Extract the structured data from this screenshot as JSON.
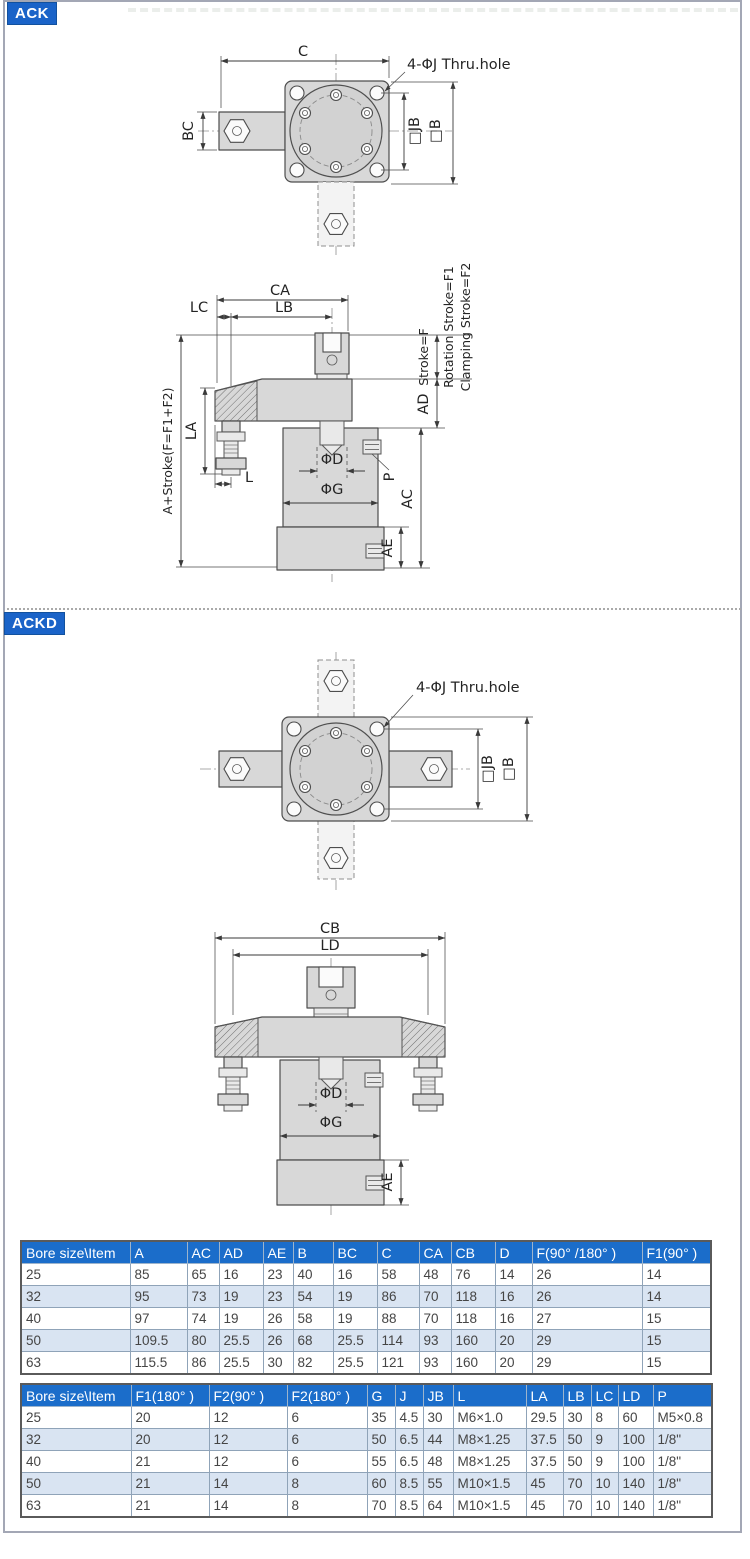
{
  "colors": {
    "badge_blue": "#1a63c8",
    "table_header_blue": "#1b6dca",
    "row_alt_blue": "#d9e4f2"
  },
  "ack": {
    "badge": "ACK",
    "top": {
      "c": "C",
      "thru_hole": "4-ΦJ Thru.hole",
      "bc": "BC",
      "jb": "□JB",
      "b": "□B"
    },
    "side": {
      "ca": "CA",
      "lb": "LB",
      "lc": "LC",
      "a_stroke": "A+Stroke(F=F1+F2)",
      "la": "LA",
      "l": "L",
      "stroke_f": "Stroke=F",
      "rotation_stroke": "Rotation Stroke=F1",
      "clamping_stroke": "Clamping Stroke=F2",
      "ad": "AD",
      "phi_d": "ΦD",
      "phi_g": "ΦG",
      "p": "P",
      "ac": "AC",
      "ae": "AE"
    }
  },
  "ackd": {
    "badge": "ACKD",
    "top": {
      "thru_hole": "4-ΦJ Thru.hole",
      "jb": "□JB",
      "b": "□B"
    },
    "side": {
      "cb": "CB",
      "ld": "LD",
      "phi_d": "ΦD",
      "phi_g": "ΦG",
      "ae": "AE"
    }
  },
  "table1": {
    "headers": [
      "Bore size\\Item",
      "A",
      "AC",
      "AD",
      "AE",
      "B",
      "BC",
      "C",
      "CA",
      "CB",
      "D",
      "F(90° /180° )",
      "F1(90° )"
    ],
    "rows": [
      [
        "25",
        "85",
        "65",
        "16",
        "23",
        "40",
        "16",
        "58",
        "48",
        "76",
        "14",
        "26",
        "14"
      ],
      [
        "32",
        "95",
        "73",
        "19",
        "23",
        "54",
        "19",
        "86",
        "70",
        "118",
        "16",
        "26",
        "14"
      ],
      [
        "40",
        "97",
        "74",
        "19",
        "26",
        "58",
        "19",
        "88",
        "70",
        "118",
        "16",
        "27",
        "15"
      ],
      [
        "50",
        "109.5",
        "80",
        "25.5",
        "26",
        "68",
        "25.5",
        "114",
        "93",
        "160",
        "20",
        "29",
        "15"
      ],
      [
        "63",
        "115.5",
        "86",
        "25.5",
        "30",
        "82",
        "25.5",
        "121",
        "93",
        "160",
        "20",
        "29",
        "15"
      ]
    ]
  },
  "table2": {
    "headers": [
      "Bore size\\Item",
      "F1(180° )",
      "F2(90° )",
      "F2(180° )",
      "G",
      "J",
      "JB",
      "L",
      "LA",
      "LB",
      "LC",
      "LD",
      "P"
    ],
    "rows": [
      [
        "25",
        "20",
        "12",
        "6",
        "35",
        "4.5",
        "30",
        "M6×1.0",
        "29.5",
        "30",
        "8",
        "60",
        "M5×0.8"
      ],
      [
        "32",
        "20",
        "12",
        "6",
        "50",
        "6.5",
        "44",
        "M8×1.25",
        "37.5",
        "50",
        "9",
        "100",
        "1/8\""
      ],
      [
        "40",
        "21",
        "12",
        "6",
        "55",
        "6.5",
        "48",
        "M8×1.25",
        "37.5",
        "50",
        "9",
        "100",
        "1/8\""
      ],
      [
        "50",
        "21",
        "14",
        "8",
        "60",
        "8.5",
        "55",
        "M10×1.5",
        "45",
        "70",
        "10",
        "140",
        "1/8\""
      ],
      [
        "63",
        "21",
        "14",
        "8",
        "70",
        "8.5",
        "64",
        "M10×1.5",
        "45",
        "70",
        "10",
        "140",
        "1/8\""
      ]
    ]
  }
}
